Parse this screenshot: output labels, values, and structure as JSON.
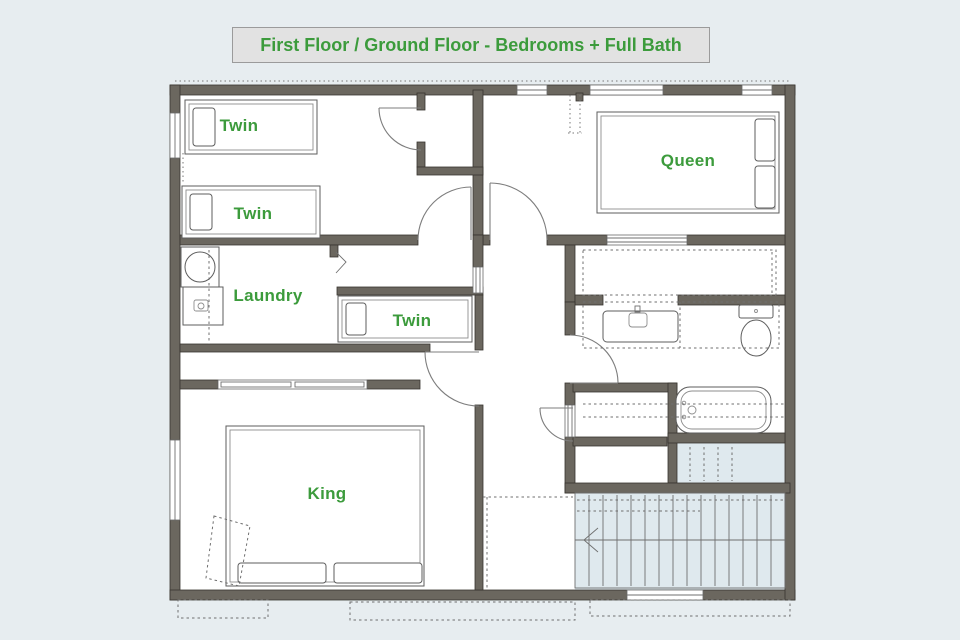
{
  "title": "First Floor / Ground Floor - Bedrooms + Full Bath",
  "colors": {
    "background": "#e7edf0",
    "plan_floor": "#ffffff",
    "wall": "#6b675f",
    "wall_outline": "#38352f",
    "label_green": "#3c9b3c",
    "title_bg": "#e2e2e2",
    "title_border": "#9b9b9b",
    "stairs_fill": "#dfe9ee"
  },
  "rooms": {
    "twin_a": {
      "label": "Twin"
    },
    "twin_b": {
      "label": "Twin"
    },
    "laundry": {
      "label": "Laundry"
    },
    "twin_c": {
      "label": "Twin"
    },
    "queen": {
      "label": "Queen"
    },
    "king": {
      "label": "King"
    }
  },
  "fixtures": {
    "beds": [
      "twin-bed",
      "twin-bed",
      "twin-bed",
      "queen-bed",
      "king-bed"
    ],
    "laundry": [
      "washer",
      "laundry-cabinet",
      "bifold-door"
    ],
    "bathroom": [
      "vanity-sink",
      "toilet",
      "bathtub"
    ],
    "circulation": [
      "staircase",
      "hallway"
    ]
  }
}
